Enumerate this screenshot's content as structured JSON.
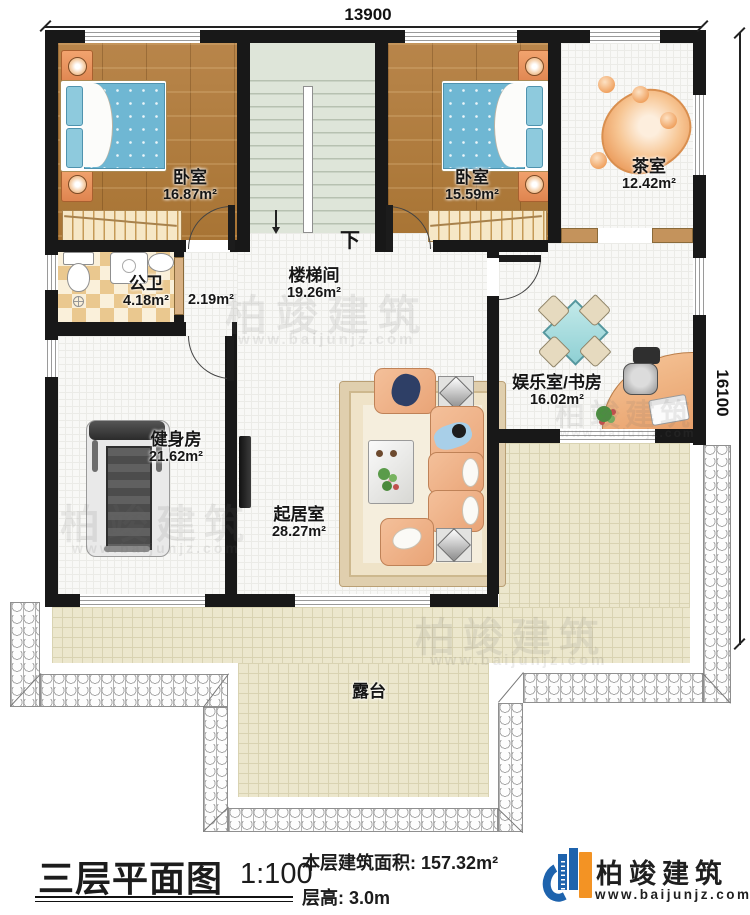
{
  "dimensions": {
    "width_mm": "13900",
    "height_mm": "16100"
  },
  "rooms": [
    {
      "name": "卧室",
      "area": "16.87m²"
    },
    {
      "name": "卧室",
      "area": "15.59m²"
    },
    {
      "name": "茶室",
      "area": "12.42m²"
    },
    {
      "name": "公卫",
      "area": "4.18m²"
    },
    {
      "name": "",
      "area": "2.19m²"
    },
    {
      "name": "楼梯间",
      "area": "19.26m²"
    },
    {
      "name": "健身房",
      "area": "21.62m²"
    },
    {
      "name": "起居室",
      "area": "28.27m²"
    },
    {
      "name": "娱乐室/书房",
      "area": "16.02m²"
    },
    {
      "name": "露台",
      "area": ""
    }
  ],
  "stairs": {
    "down_label": "下"
  },
  "title_block": {
    "plan_title": "三层平面图",
    "scale": "1:100",
    "area_label": "本层建筑面积:",
    "area_value": "157.32m²",
    "height_label": "层高:",
    "height_value": "3.0m"
  },
  "brand": {
    "name": "柏竣建筑",
    "website": "www.baijunjz.com"
  },
  "watermark": {
    "name": "柏竣建筑",
    "website": "www.baijunjz.com"
  },
  "colors": {
    "brand_blue": "#1e63ad",
    "brand_orange": "#f39324",
    "wall": "#181818"
  }
}
